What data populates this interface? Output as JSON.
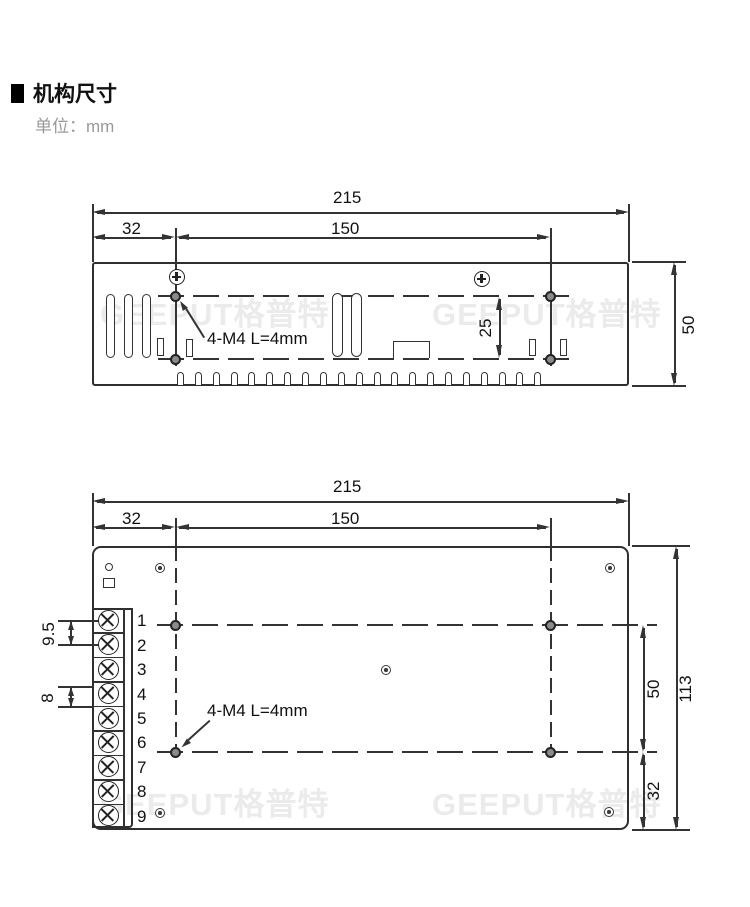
{
  "page": {
    "title": "机构尺寸",
    "unit": "单位：mm",
    "watermark": "GEEPUT格普特"
  },
  "top_view": {
    "dims": {
      "total_width": "215",
      "left_offset": "32",
      "mount_spacing": "150",
      "hole_rise": "25",
      "height": "50"
    },
    "screw_note": "4-M4 L=4mm"
  },
  "bottom_view": {
    "dims": {
      "total_width": "215",
      "left_offset": "32",
      "mount_spacing": "150",
      "mid_span": "50",
      "bottom_offset": "32",
      "height": "113",
      "terminal_pitch_a": "9.5",
      "terminal_pitch_b": "8"
    },
    "screw_note": "4-M4 L=4mm",
    "terminals": [
      "1",
      "2",
      "3",
      "4",
      "5",
      "6",
      "7",
      "8",
      "9"
    ]
  }
}
